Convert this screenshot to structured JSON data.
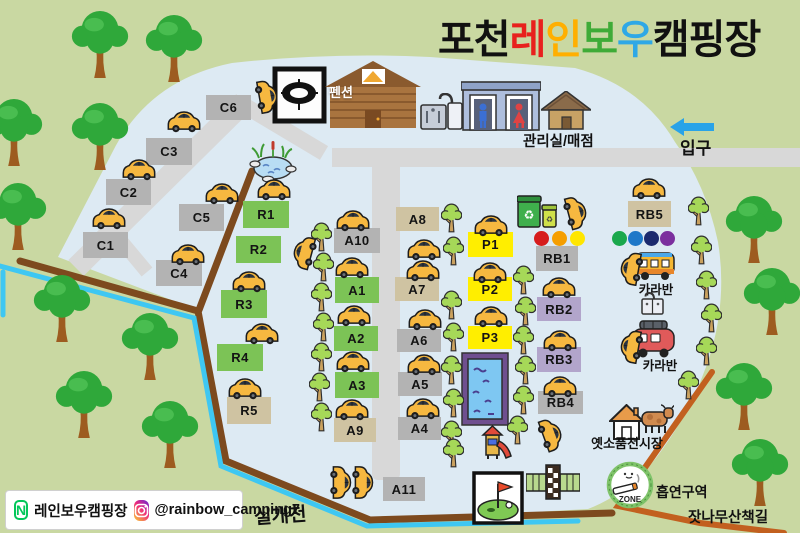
{
  "title": {
    "prefix": "포천 ",
    "rainbow": [
      {
        "ch": "레",
        "color": "#e8211d"
      },
      {
        "ch": "인",
        "color": "#ffaf00"
      },
      {
        "ch": "보",
        "color": "#3fab37"
      },
      {
        "ch": "우",
        "color": "#2ea8e6"
      }
    ],
    "suffix": " 캠핑장"
  },
  "sites": {
    "c": [
      "C1",
      "C2",
      "C3",
      "C4",
      "C5",
      "C6"
    ],
    "r": [
      "R1",
      "R2",
      "R3",
      "R4",
      "R5"
    ],
    "a": [
      "A1",
      "A2",
      "A3",
      "A4",
      "A5",
      "A6",
      "A7",
      "A8",
      "A9",
      "A10",
      "A11"
    ],
    "p": [
      "P1",
      "P2",
      "P3"
    ],
    "rb": [
      "RB1",
      "RB2",
      "RB3",
      "RB4",
      "RB5"
    ]
  },
  "facilities": {
    "pension": "펜션",
    "office_store": "관리실/매점",
    "entrance": "입구",
    "caravan_top": "카라반",
    "caravan_bottom": "카라반",
    "exhibition": "옛소품전시장",
    "smoking_area": "흡연구역",
    "smoking_zone_text": "ZONE",
    "pine_trail": "잣나무산책길",
    "stream": "실개천"
  },
  "icons": {
    "recycle": "♻"
  },
  "legend_dots": {
    "warm": [
      "#d61c1c",
      "#f59e00",
      "#ffe600"
    ],
    "cool": [
      "#1aa84c",
      "#1e78c8",
      "#1b2a6e",
      "#7b2f9e"
    ]
  },
  "footer": {
    "naver_initial": "N",
    "naver_name": "레인보우캠핑장",
    "instagram_handle": "@rainbow_camping7"
  },
  "colors": {
    "ground": "#c9d8a2",
    "camp": "#ddeaf3",
    "road": "#d8d8d8",
    "site_gray": "#b3b3b3",
    "site_green": "#7cc356",
    "site_tan": "#cfc3a2",
    "site_yellow": "#ffee00",
    "site_purple": "#b2a5cb",
    "path_brown": "#7d4a1e",
    "path_orange": "#c2601f",
    "stream_blue": "#3ec7f2"
  }
}
